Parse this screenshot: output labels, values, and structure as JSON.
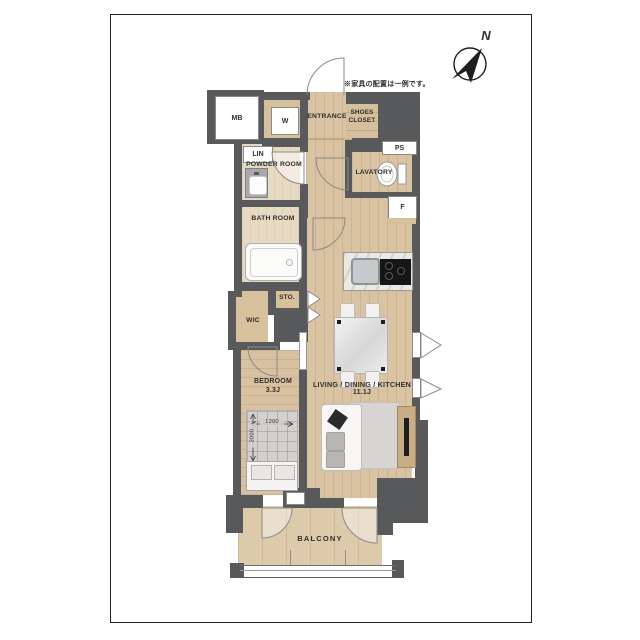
{
  "page": {
    "title": "apartment-floor-plan"
  },
  "note": "※家具の配置は一例です。",
  "compass": {
    "north_label": "N"
  },
  "rooms": {
    "mb": "MB",
    "w_closet": "W",
    "entrance": "ENTRANCE",
    "shoes_closet": "SHOES CLOSET",
    "ps": "PS",
    "lin": "LIN",
    "powder_room": "POWDER ROOM",
    "lavatory": "LAVATORY",
    "refrigerator": "F",
    "bath_room": "BATH ROOM",
    "storage": "STO.",
    "wic": "WIC",
    "bedroom": "BEDROOM",
    "bedroom_size": "3.3J",
    "ldk": "LIVING / DINING / KITCHEN",
    "ldk_size": "11.1J",
    "balcony": "BALCONY"
  },
  "dimensions": {
    "bed_width_mm": "1200",
    "bed_length_mm": "2000"
  },
  "colors": {
    "wall": "#58595b",
    "wood_floor": "#d9c3a2",
    "closet_tan": "#d7c09c",
    "bath_floor": "#e7dac3",
    "balcony_floor": "#dccaab",
    "frame_border": "#222222",
    "label_text": "#2f2f2f"
  }
}
